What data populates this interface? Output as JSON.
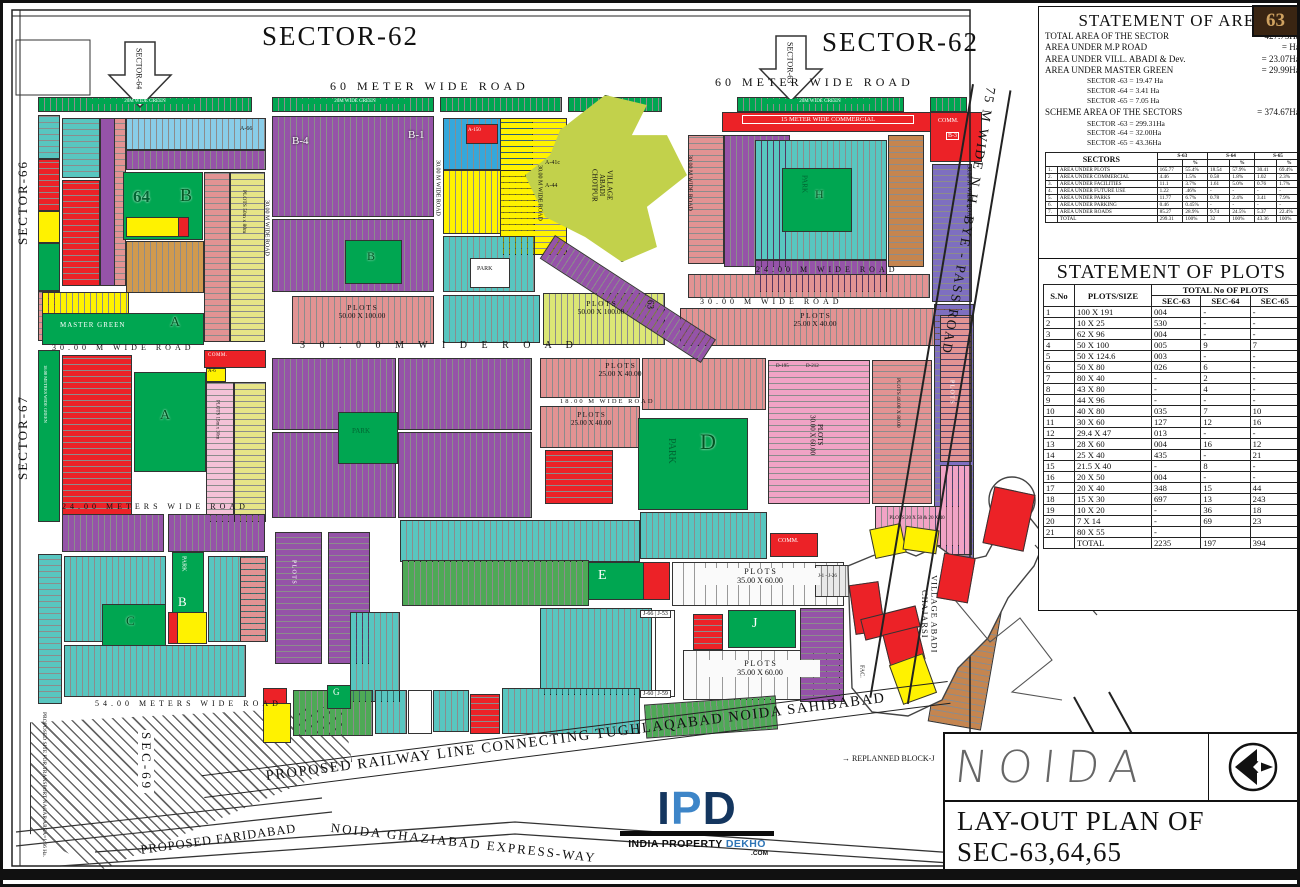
{
  "badge": "63",
  "colors": {
    "green": "#00A651",
    "purple": "#9553A8",
    "violet": "#7E6FC0",
    "teal": "#58C6C0",
    "light_blue": "#89CDE8",
    "blue": "#35A8DC",
    "salmon": "#E29393",
    "pink": "#F1A3C5",
    "red": "#EC2227",
    "yellow": "#FFF200",
    "olive": "#C2D14B",
    "khaki": "#E6E487",
    "brown": "#C5854F",
    "logo_navy": "#14365F",
    "logo_blue": "#3D85C8"
  },
  "top": {
    "sector62_left": "SECTOR-62",
    "sector62_right": "SECTOR-62",
    "arrow_left_label": "SECTOR-64",
    "arrow_right_label": "SECTOR-63",
    "road60_left": "60   METER      WIDE      ROAD",
    "road60_right": "60   METER      WIDE      ROAD"
  },
  "edges": {
    "sector66": "SECTOR-66",
    "sector67": "SECTOR-67",
    "sec69": "SEC-69",
    "bypass": "75 M   WIDE       N.H.    BYE - PASS    ROAD",
    "transport_nagar": "PROPOSED SITE FOR TRANSPORT NAGAR AREA=1.66 Ha."
  },
  "bottom": {
    "railway": "PROPOSED RAILWAY LINE CONNECTING TUGHLAQABAD NOIDA SAHIBABAD",
    "faridabad": "PROPOSED FARIDABAD",
    "expressway": "NOIDA GHAZIABAD EXPRESS-WAY",
    "replanned": "→ REPLANNED BLOCK-J"
  },
  "logo": {
    "ipd": "IPD",
    "tagline_black": "INDIA PROPERTY ",
    "tagline_blue": "DEKHO",
    "com": ".COM"
  },
  "titleblock": {
    "noida": "NOIDA",
    "line1": "LAY-OUT PLAN OF",
    "line2": "SEC-63,64,65"
  },
  "area_statement": {
    "title": "STATEMENT OF AREA",
    "rows": [
      {
        "label": "TOTAL AREA OF THE SECTOR",
        "value": "=  427.73Ha."
      },
      {
        "label": "AREA UNDER M.P ROAD",
        "value": "=  Ha."
      },
      {
        "label": "AREA UNDER VILL. ABADI & Dev.",
        "value": "=  23.07Ha."
      },
      {
        "label": "AREA UNDER MASTER GREEN",
        "value": "=  29.99Ha."
      }
    ],
    "master_green_breakup": [
      "SECTOR -63 =   19.47 Ha",
      "SECTOR -64 =   3.41 Ha",
      "SECTOR -65 =   7.05 Ha"
    ],
    "scheme_label": "SCHEME AREA OF THE SECTORS",
    "scheme_value": "=  374.67Ha.",
    "scheme_breakup": [
      "SECTOR -63 =   299.31Ha",
      "SECTOR -64 =   32.00Ha",
      "SECTOR -65 =   43.36Ha"
    ]
  },
  "sectors_table": {
    "header": "SECTORS",
    "col_groups": [
      "S-63",
      "S-64",
      "S-65"
    ],
    "pct": "%",
    "rows": [
      [
        "1.",
        "AREA UNDER PLOTS",
        "165.77",
        "55.4%",
        "18.54",
        "57.9%",
        "30.41",
        "69.4%"
      ],
      [
        "2.",
        "AREA UNDER COMMERCIAL",
        "4.46",
        "1.5%",
        "0.58",
        "1.8%",
        "1.02",
        "2.3%"
      ],
      [
        "3.",
        "AREA UNDER FACILITIES",
        "11.1",
        "3.7%",
        "1.61",
        "5.0%",
        "0.76",
        "1.7%"
      ],
      [
        "4.",
        "AREA UNDER FUTURE USE",
        "1.22",
        ".46%",
        "-",
        "-",
        "-",
        "-"
      ],
      [
        "5.",
        "AREA UNDER PARKS",
        "11.77",
        "6.7%",
        "0.78",
        "2.4%",
        "3.41",
        "7.9%"
      ],
      [
        "6.",
        "AREA UNDER PARKING",
        "0.46",
        "0.45%",
        "-",
        "-",
        "-",
        "-"
      ],
      [
        "7.",
        "AREA UNDER ROADS",
        "85.27",
        "28.9%",
        "9.74",
        "24.5%",
        "5.37",
        "22.4%"
      ],
      [
        "",
        "TOTAL",
        "299.31",
        "100%",
        "32",
        "100%",
        "43.36",
        "100%"
      ]
    ]
  },
  "plots_table": {
    "title": "STATEMENT OF PLOTS",
    "h_sno": "S.No",
    "h_size": "PLOTS/SIZE",
    "h_total": "TOTAL No OF PLOTS",
    "h_cols": [
      "SEC-63",
      "SEC-64",
      "SEC-65"
    ],
    "rows": [
      [
        "1",
        "100 X 191",
        "004",
        "-",
        "-"
      ],
      [
        "2",
        "10 X 25",
        "530",
        "-",
        "-"
      ],
      [
        "3",
        "62 X 96",
        "004",
        "-",
        "-"
      ],
      [
        "4",
        "50 X 100",
        "005",
        "9",
        "7"
      ],
      [
        "5",
        "50 X 124.6",
        "003",
        "-",
        "-"
      ],
      [
        "6",
        "50 X 80",
        "026",
        "6",
        "-"
      ],
      [
        "7",
        "80 X 40",
        "-",
        "2",
        "-"
      ],
      [
        "8",
        "43 X 80",
        "-",
        "4",
        "-"
      ],
      [
        "9",
        "44 X 96",
        "-",
        "-",
        "-"
      ],
      [
        "10",
        "40 X 80",
        "035",
        "7",
        "10"
      ],
      [
        "11",
        "30 X 60",
        "127",
        "12",
        "16"
      ],
      [
        "12",
        "29.4 X 47",
        "013",
        "-",
        "-"
      ],
      [
        "13",
        "28 X 60",
        "004",
        "16",
        "12"
      ],
      [
        "14",
        "25 X 40",
        "435",
        "-",
        "21"
      ],
      [
        "15",
        "21.5 X 40",
        "-",
        "8",
        "-"
      ],
      [
        "16",
        "20 X 50",
        "004",
        "-",
        "-"
      ],
      [
        "17",
        "20 X 40",
        "348",
        "15",
        "44"
      ],
      [
        "18",
        "15 X 30",
        "697",
        "13",
        "243"
      ],
      [
        "19",
        "10 X 20",
        "-",
        "36",
        "18"
      ],
      [
        "20",
        "7 X 14",
        "-",
        "69",
        "23"
      ],
      [
        "21",
        "80 X 55",
        "-",
        "",
        ""
      ],
      [
        "",
        "TOTAL",
        "2235",
        "197",
        "394"
      ]
    ]
  },
  "map": {
    "labels": {
      "green_strip": "20M   WIDE   GREEN",
      "road_30m_v": "30.00 M   WIDE   ROAD",
      "road_30m_h": "3 0 . 0 0    M        W I D E        R O A D",
      "road_30m_s": "30.00 M      WIDE      ROAD",
      "road_24m": "24.00 M      WIDE      ROAD",
      "road_18m": "18.00 M   WIDE   ROAD",
      "road_24meters": "24.00    METERS    WIDE    ROAD",
      "road_54meters": "54.00    METERS    WIDE    ROAD",
      "green_18m": "18.00 METRES WIDE GREEN",
      "comm15": "15 METER WIDE COMMERCIAL",
      "plots_50x100": "P L O T S\n50.00 X 100.00",
      "plots_25x40": "P L O T S\n25.00 X 40.00",
      "plots_30x60": "PLOTS\n30.00 X 60.00",
      "plots_35x60": "P L O T S\n35.00 X 60.00",
      "plots_40x80": "PLOTS 40.00 X 80.00",
      "plots_20x50": "PLOTS 20 X 50 & 20 X 40",
      "plots_50x80": "PLOTS 50m x 80m",
      "plots_15x30": "PLOTS 15m x 30m",
      "plots_word": "P L O T S",
      "village_chotpur": "VILLAGE\nABADI\nCHOTPUR",
      "village_chajarsi": "VILLAGE ABADI\nCHAJARSI",
      "master_green": "MASTER GREEN",
      "blk64": "64",
      "blkB": "B",
      "park": "PARK",
      "blkD": "D",
      "blkH": "H",
      "blkE": "E",
      "blkJ": "J",
      "blkC": "C",
      "blkG": "G",
      "blkA": "A",
      "b4": "B-4",
      "b1": "B-1",
      "b3": "B-3",
      "a66": "A-66",
      "a44": "A-44",
      "a41c": "A-41c",
      "a150": "A-150",
      "a6": "A-6",
      "n63": "63",
      "comm": "COMM.",
      "fac": "FAC.",
      "d195": "D-195",
      "d212": "D-212",
      "j66_53": "J-66 | J-53",
      "j60_59": "J-60 | J-59",
      "j1_26": "J-1 - J-26"
    }
  }
}
